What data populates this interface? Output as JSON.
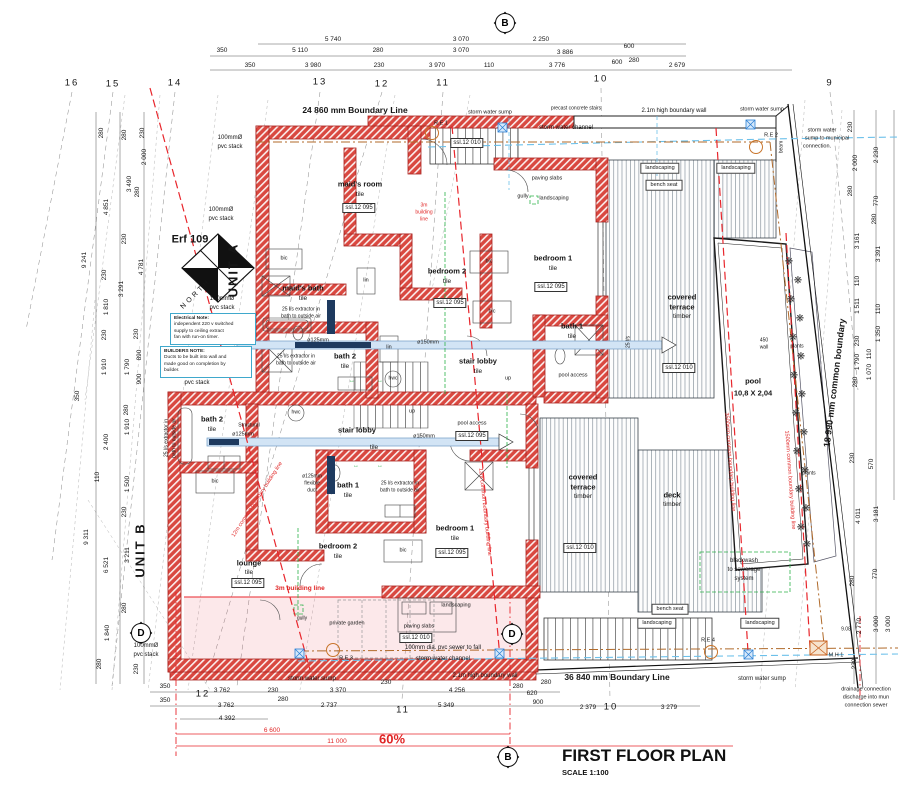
{
  "title": {
    "main": "FIRST FLOOR PLAN",
    "scale": "SCALE 1:100"
  },
  "colors": {
    "wall_red": "#d94840",
    "building_line_red": "#e8262c",
    "duct_blue": "#d2e4f5",
    "water_cyan": "#6cc0ea",
    "sewer_brown": "#b06a2a",
    "services_green": "#2cb14a",
    "note_border": "#3fa8cc"
  },
  "markers": [
    {
      "t": "B",
      "x": 505,
      "y": 23
    },
    {
      "t": "B",
      "x": 508,
      "y": 757
    },
    {
      "t": "D",
      "x": 141,
      "y": 633
    },
    {
      "t": "D",
      "x": 512,
      "y": 634
    }
  ],
  "notes": [
    {
      "x": 170,
      "y": 313,
      "w": 78,
      "lines": [
        "Electrical Note:",
        "independent 220 v switched",
        "supply to ceiling extract",
        "fan with run-on timer."
      ]
    },
    {
      "x": 160,
      "y": 346,
      "w": 84,
      "lines": [
        "BUILDERS NOTE:",
        "Ducts to be built into wall and",
        "made good on completion by",
        "builder."
      ]
    }
  ],
  "planter": {
    "glyph": "❋",
    "points": [
      [
        789,
        262
      ],
      [
        798,
        281
      ],
      [
        791,
        300
      ],
      [
        800,
        319
      ],
      [
        793,
        338
      ],
      [
        801,
        357
      ],
      [
        794,
        376
      ],
      [
        802,
        395
      ],
      [
        796,
        414
      ],
      [
        804,
        433
      ],
      [
        797,
        452
      ],
      [
        805,
        471
      ],
      [
        799,
        490
      ],
      [
        806,
        509
      ],
      [
        801,
        528
      ],
      [
        807,
        545
      ]
    ]
  },
  "labels": [
    [
      "5 740",
      333,
      40,
      "dim"
    ],
    [
      "3 070",
      461,
      40,
      "dim"
    ],
    [
      "2 250",
      541,
      40,
      "dim"
    ],
    [
      "350",
      222,
      51,
      "dim"
    ],
    [
      "5 110",
      300,
      51,
      "dim"
    ],
    [
      "280",
      378,
      51,
      "dim"
    ],
    [
      "3 070",
      461,
      51,
      "dim"
    ],
    [
      "3 886",
      565,
      53,
      "dim"
    ],
    [
      "600",
      629,
      47,
      "dim"
    ],
    [
      "350",
      250,
      66,
      "dim"
    ],
    [
      "3 980",
      313,
      66,
      "dim"
    ],
    [
      "230",
      379,
      66,
      "dim"
    ],
    [
      "3 970",
      437,
      66,
      "dim"
    ],
    [
      "110",
      489,
      66,
      "dim"
    ],
    [
      "3 776",
      557,
      66,
      "dim"
    ],
    [
      "600",
      617,
      63,
      "dim"
    ],
    [
      "280",
      634,
      61,
      "dim"
    ],
    [
      "2 679",
      677,
      66,
      "dim"
    ],
    [
      "16",
      72,
      83,
      "grid"
    ],
    [
      "15",
      113,
      84,
      "grid"
    ],
    [
      "14",
      175,
      83,
      "grid"
    ],
    [
      "13",
      320,
      82,
      "grid"
    ],
    [
      "12",
      382,
      84,
      "grid"
    ],
    [
      "11",
      443,
      83,
      "grid"
    ],
    [
      "10",
      601,
      79,
      "grid"
    ],
    [
      "9",
      830,
      83,
      "grid"
    ],
    [
      "12",
      203,
      694,
      "grid"
    ],
    [
      "11",
      403,
      710,
      "grid"
    ],
    [
      "10",
      611,
      707,
      "grid"
    ],
    [
      "24  860 mm Boundary Line",
      355,
      110,
      "bold"
    ],
    [
      "storm water sump",
      490,
      113,
      "tiny"
    ],
    [
      "precast concrete stairs",
      576,
      109,
      "micro"
    ],
    [
      "2.1m high boundary wall",
      674,
      111,
      "small"
    ],
    [
      "storm water sump",
      762,
      110,
      "tiny"
    ],
    [
      "storm water channel",
      566,
      128,
      "small"
    ],
    [
      "storm water",
      822,
      131,
      "tiny"
    ],
    [
      "sump to municipal",
      827,
      139,
      "tiny"
    ],
    [
      "connection.",
      817,
      147,
      "tiny"
    ],
    [
      "R.E 1",
      441,
      124,
      "tiny"
    ],
    [
      "R.E 2",
      771,
      136,
      "tiny"
    ],
    [
      "ssl.12 010",
      467,
      143,
      "box"
    ],
    [
      "beam",
      782,
      147,
      "tinyv",
      -90
    ],
    [
      "100mmØ",
      230,
      138,
      "small"
    ],
    [
      "pvc stack",
      230,
      147,
      "small"
    ],
    [
      "100mmØ",
      221,
      210,
      "small"
    ],
    [
      "pvc stack",
      221,
      219,
      "small"
    ],
    [
      "100mmØ",
      222,
      299,
      "small"
    ],
    [
      "pvc stack",
      222,
      308,
      "small"
    ],
    [
      "100mmØ",
      197,
      374,
      "small"
    ],
    [
      "pvc stack",
      197,
      383,
      "small"
    ],
    [
      "Erf 109",
      190,
      240,
      "erf"
    ],
    [
      "UNIT A",
      233,
      270,
      "unit",
      -90
    ],
    [
      "NORTH",
      196,
      294,
      "north",
      -45
    ],
    [
      "maid's room",
      360,
      184,
      "room"
    ],
    [
      "tile",
      360,
      195,
      "tile"
    ],
    [
      "ssl.12 095",
      359,
      208,
      "box"
    ],
    [
      "3m",
      424,
      206,
      "redtiny"
    ],
    [
      "building",
      424,
      213,
      "redtiny"
    ],
    [
      "line",
      424,
      220,
      "redtiny"
    ],
    [
      "bic",
      284,
      259,
      "tiny"
    ],
    [
      "lin",
      366,
      281,
      "tiny"
    ],
    [
      "maid's bath",
      303,
      288,
      "room"
    ],
    [
      "tile",
      303,
      299,
      "tile"
    ],
    [
      "25 l/s  extractor in",
      301,
      310,
      "micro"
    ],
    [
      "bath to outside air",
      301,
      317,
      "micro"
    ],
    [
      "bedroom 2",
      447,
      271,
      "room"
    ],
    [
      "tile",
      447,
      282,
      "tile"
    ],
    [
      "ssl.12 095",
      450,
      303,
      "box"
    ],
    [
      "bedroom 1",
      553,
      258,
      "room"
    ],
    [
      "tile",
      553,
      269,
      "tile"
    ],
    [
      "ssl.12 095",
      551,
      287,
      "box"
    ],
    [
      "bic",
      489,
      262,
      "tiny"
    ],
    [
      "bic",
      492,
      312,
      "tiny"
    ],
    [
      "ø125mm",
      318,
      341,
      "tiny"
    ],
    [
      "ø150mm",
      428,
      343,
      "tiny"
    ],
    [
      "lin",
      389,
      348,
      "tiny"
    ],
    [
      "25 l/s  extractor in",
      296,
      357,
      "micro"
    ],
    [
      "bath to outside air",
      296,
      364,
      "micro"
    ],
    [
      "bath 2",
      345,
      356,
      "room"
    ],
    [
      "tile",
      345,
      367,
      "tile"
    ],
    [
      "hwc",
      393,
      379,
      "micro"
    ],
    [
      "hwc",
      296,
      413,
      "micro"
    ],
    [
      "stair lobby",
      478,
      361,
      "room"
    ],
    [
      "tile",
      478,
      372,
      "tile"
    ],
    [
      "up",
      508,
      379,
      "tiny"
    ],
    [
      "bath 1",
      572,
      326,
      "room"
    ],
    [
      "tile",
      572,
      337,
      "tile"
    ],
    [
      "pool access",
      573,
      376,
      "tiny"
    ],
    [
      "25 l/s",
      629,
      342,
      "tinyv",
      -90
    ],
    [
      "paving slabs",
      547,
      179,
      "tiny"
    ],
    [
      "gully",
      523,
      197,
      "tiny"
    ],
    [
      "landscaping",
      554,
      199,
      "tiny"
    ],
    [
      "landscaping",
      660,
      168,
      "boxlabel"
    ],
    [
      "landscaping",
      736,
      168,
      "boxlabel"
    ],
    [
      "bench seat",
      664,
      185,
      "boxlabel"
    ],
    [
      "covered",
      682,
      297,
      "room"
    ],
    [
      "terrace",
      682,
      307,
      "room"
    ],
    [
      "timber",
      682,
      317,
      "tile"
    ],
    [
      "ssl.12 010",
      679,
      368,
      "box"
    ],
    [
      "450",
      764,
      341,
      "micro"
    ],
    [
      "wall",
      764,
      348,
      "micro"
    ],
    [
      "plants",
      797,
      347,
      "micro"
    ],
    [
      "plants",
      809,
      474,
      "micro"
    ],
    [
      "pool",
      753,
      381,
      "room"
    ],
    [
      "10,8 X 2,04",
      753,
      393,
      "room"
    ],
    [
      "18 990 mm common boundary",
      835,
      383,
      "boundv",
      -83
    ],
    [
      "bath 2",
      212,
      419,
      "room"
    ],
    [
      "tile",
      212,
      430,
      "tile"
    ],
    [
      "25 l/s  extractor in",
      167,
      438,
      "tinyv",
      -90
    ],
    [
      "bath to outside air",
      175,
      438,
      "tinyv",
      -90
    ],
    [
      "Structural",
      249,
      426,
      "micro"
    ],
    [
      "ø125mm",
      243,
      435,
      "tiny"
    ],
    [
      "ø150mm",
      424,
      437,
      "tiny"
    ],
    [
      "stair lobby",
      357,
      430,
      "room"
    ],
    [
      "tile",
      374,
      448,
      "tile"
    ],
    [
      "up",
      412,
      412,
      "tiny"
    ],
    [
      "pool access",
      472,
      424,
      "tiny"
    ],
    [
      "ssl.12 095",
      472,
      436,
      "box"
    ],
    [
      "bic",
      215,
      482,
      "tiny"
    ],
    [
      "bath 1",
      348,
      485,
      "room"
    ],
    [
      "tile",
      348,
      496,
      "tile"
    ],
    [
      "ø125mm",
      312,
      477,
      "micro"
    ],
    [
      "flexible",
      312,
      484,
      "micro"
    ],
    [
      "duct",
      312,
      491,
      "micro"
    ],
    [
      "25 l/s  extractor in",
      400,
      484,
      "micro"
    ],
    [
      "bath to outside air",
      400,
      491,
      "micro"
    ],
    [
      "bedroom 2",
      338,
      546,
      "room"
    ],
    [
      "tile",
      338,
      557,
      "tile"
    ],
    [
      "bic",
      403,
      551,
      "tiny"
    ],
    [
      "bedroom 1",
      455,
      528,
      "room"
    ],
    [
      "tile",
      455,
      539,
      "tile"
    ],
    [
      "ssl.12 095",
      452,
      553,
      "box"
    ],
    [
      "lounge",
      249,
      563,
      "room"
    ],
    [
      "tile",
      249,
      573,
      "tile"
    ],
    [
      "ssl.12 095",
      248,
      583,
      "box"
    ],
    [
      "UNIT B",
      140,
      550,
      "unit",
      -90
    ],
    [
      "covered",
      583,
      477,
      "room"
    ],
    [
      "terrace",
      583,
      487,
      "room"
    ],
    [
      "timber",
      583,
      497,
      "tile"
    ],
    [
      "ssl.12 010",
      580,
      548,
      "box"
    ],
    [
      "deck",
      672,
      495,
      "room"
    ],
    [
      "timber",
      672,
      505,
      "tile"
    ],
    [
      "blackwash",
      744,
      561,
      "small"
    ],
    [
      "to sewerage",
      744,
      570,
      "small"
    ],
    [
      "system",
      744,
      579,
      "small"
    ],
    [
      "bench seat",
      670,
      609,
      "boxlabel"
    ],
    [
      "landscaping",
      657,
      623,
      "boxlabel"
    ],
    [
      "landscaping",
      760,
      623,
      "boxlabel"
    ],
    [
      "landscaping",
      456,
      606,
      "tiny"
    ],
    [
      "3m building line",
      300,
      589,
      "red"
    ],
    [
      "gully",
      302,
      619,
      "micro"
    ],
    [
      "private garden",
      347,
      624,
      "tiny"
    ],
    [
      "paving slabs",
      419,
      627,
      "tiny"
    ],
    [
      "ssl.12 010",
      416,
      638,
      "box"
    ],
    [
      "100mm dia. pvc sewer  to fall",
      443,
      648,
      "small"
    ],
    [
      "storm water channel",
      443,
      659,
      "small"
    ],
    [
      "R.E 3",
      346,
      659,
      "tiny"
    ],
    [
      "R.E 4",
      708,
      641,
      "tiny"
    ],
    [
      "M.H 1",
      836,
      656,
      "tiny"
    ],
    [
      "100mmØ",
      146,
      646,
      "small"
    ],
    [
      "pvc stack",
      146,
      655,
      "small"
    ],
    [
      "2.1m high boundary wall",
      485,
      676,
      "small"
    ],
    [
      "36  840 mm Boundary Line",
      617,
      677,
      "bold"
    ],
    [
      "storm water sump",
      312,
      679,
      "small"
    ],
    [
      "storm water sump",
      762,
      679,
      "small"
    ],
    [
      "drainage connection",
      866,
      690,
      "tiny"
    ],
    [
      "discharge into mun",
      866,
      698,
      "tiny"
    ],
    [
      "connection sewer",
      866,
      706,
      "tiny"
    ],
    [
      "9.08",
      846,
      630,
      "micro"
    ],
    [
      "12m common boundary building line",
      484,
      512,
      "redv",
      84
    ],
    [
      "12m common boundary building line",
      258,
      500,
      "redv",
      -57
    ],
    [
      "3500mm common boundary building line",
      729,
      462,
      "redv",
      86
    ],
    [
      "1500mm common boundary building line",
      789,
      480,
      "redv",
      86
    ],
    [
      "280",
      102,
      133,
      "dimv",
      -90
    ],
    [
      "280",
      125,
      135,
      "dimv",
      -90
    ],
    [
      "230",
      143,
      133,
      "dimv",
      -90
    ],
    [
      "2 000",
      145,
      157,
      "dimv",
      -90
    ],
    [
      "3 490",
      130,
      184,
      "dimv",
      -90
    ],
    [
      "280",
      138,
      192,
      "dimv",
      -90
    ],
    [
      "4 851",
      107,
      207,
      "dimv",
      -90
    ],
    [
      "230",
      125,
      239,
      "dimv",
      -90
    ],
    [
      "9 241",
      85,
      260,
      "dimv",
      -90
    ],
    [
      "4 781",
      142,
      267,
      "dimv",
      -90
    ],
    [
      "230",
      105,
      275,
      "dimv",
      -90
    ],
    [
      "3 291",
      122,
      289,
      "dimv",
      -90
    ],
    [
      "1 810",
      107,
      307,
      "dimv",
      -90
    ],
    [
      "230",
      137,
      334,
      "dimv",
      -90
    ],
    [
      "230",
      105,
      335,
      "dimv",
      -90
    ],
    [
      "890",
      140,
      355,
      "dimv",
      -90
    ],
    [
      "1 910",
      105,
      367,
      "dimv",
      -90
    ],
    [
      "1 790",
      128,
      367,
      "dimv",
      -90
    ],
    [
      "900",
      140,
      379,
      "dimv",
      -90
    ],
    [
      "350",
      78,
      396,
      "dimv",
      -90
    ],
    [
      "280",
      127,
      410,
      "dimv",
      -90
    ],
    [
      "1 910",
      128,
      427,
      "dimv",
      -90
    ],
    [
      "2 400",
      107,
      442,
      "dimv",
      -90
    ],
    [
      "110",
      98,
      477,
      "dimv",
      -90
    ],
    [
      "1 500",
      128,
      484,
      "dimv",
      -90
    ],
    [
      "230",
      125,
      512,
      "dimv",
      -90
    ],
    [
      "9 311",
      87,
      537,
      "dimv",
      -90
    ],
    [
      "3 211",
      128,
      555,
      "dimv",
      -90
    ],
    [
      "6 521",
      107,
      565,
      "dimv",
      -90
    ],
    [
      "280",
      125,
      608,
      "dimv",
      -90
    ],
    [
      "1 840",
      108,
      633,
      "dimv",
      -90
    ],
    [
      "280",
      100,
      664,
      "dimv",
      -90
    ],
    [
      "230",
      137,
      669,
      "dimv",
      -90
    ],
    [
      "230",
      851,
      127,
      "dimv",
      -90
    ],
    [
      "2 230",
      877,
      155,
      "dimv",
      -90
    ],
    [
      "2 000",
      856,
      163,
      "dimv",
      -90
    ],
    [
      "280",
      851,
      191,
      "dimv",
      -90
    ],
    [
      "770",
      877,
      201,
      "dimv",
      -90
    ],
    [
      "280",
      875,
      219,
      "dimv",
      -90
    ],
    [
      "3 161",
      858,
      241,
      "dimv",
      -90
    ],
    [
      "3 391",
      879,
      254,
      "dimv",
      -90
    ],
    [
      "110",
      858,
      281,
      "dimv",
      -90
    ],
    [
      "1 511",
      858,
      306,
      "dimv",
      -90
    ],
    [
      "110",
      879,
      309,
      "dimv",
      -90
    ],
    [
      "1 350",
      879,
      334,
      "dimv",
      -90
    ],
    [
      "230",
      858,
      341,
      "dimv",
      -90
    ],
    [
      "110",
      870,
      354,
      "dimv",
      -90
    ],
    [
      "1 790",
      858,
      362,
      "dimv",
      -90
    ],
    [
      "1 070",
      870,
      372,
      "dimv",
      -90
    ],
    [
      "280",
      856,
      382,
      "dimv",
      -90
    ],
    [
      "230",
      853,
      458,
      "dimv",
      -90
    ],
    [
      "570",
      872,
      464,
      "dimv",
      -90
    ],
    [
      "4 011",
      859,
      516,
      "dimv",
      -90
    ],
    [
      "3 181",
      877,
      514,
      "dimv",
      -90
    ],
    [
      "770",
      876,
      574,
      "dimv",
      -90
    ],
    [
      "280",
      853,
      581,
      "dimv",
      -90
    ],
    [
      "2 770",
      860,
      626,
      "dimv",
      -90
    ],
    [
      "3 000",
      877,
      624,
      "dimv",
      -90
    ],
    [
      "3 000",
      889,
      624,
      "dimv",
      -90
    ],
    [
      "230",
      855,
      664,
      "dimv",
      -90
    ],
    [
      "350",
      165,
      687,
      "dim"
    ],
    [
      "3 762",
      222,
      691,
      "dim"
    ],
    [
      "230",
      273,
      691,
      "dim"
    ],
    [
      "3 370",
      338,
      691,
      "dim"
    ],
    [
      "230",
      386,
      683,
      "dim"
    ],
    [
      "4 256",
      457,
      691,
      "dim"
    ],
    [
      "280",
      518,
      687,
      "dim"
    ],
    [
      "620",
      532,
      694,
      "dim"
    ],
    [
      "280",
      546,
      683,
      "dim"
    ],
    [
      "350",
      165,
      701,
      "dim"
    ],
    [
      "3 762",
      226,
      706,
      "dim"
    ],
    [
      "280",
      283,
      700,
      "dim"
    ],
    [
      "2 737",
      329,
      706,
      "dim"
    ],
    [
      "5 349",
      446,
      706,
      "dim"
    ],
    [
      "900",
      538,
      703,
      "dim"
    ],
    [
      "2 379",
      588,
      708,
      "dim"
    ],
    [
      "3 279",
      669,
      708,
      "dim"
    ],
    [
      "4 392",
      227,
      719,
      "dim"
    ],
    [
      "6 600",
      272,
      731,
      "reddim"
    ],
    [
      "11 000",
      337,
      742,
      "reddim"
    ],
    [
      "60%",
      392,
      739,
      "redpct"
    ],
    [
      "↔",
      352,
      381,
      "green"
    ],
    [
      "↔",
      380,
      381,
      "green"
    ],
    [
      "↔",
      356,
      466,
      "green"
    ],
    [
      "↔",
      380,
      466,
      "green"
    ]
  ]
}
